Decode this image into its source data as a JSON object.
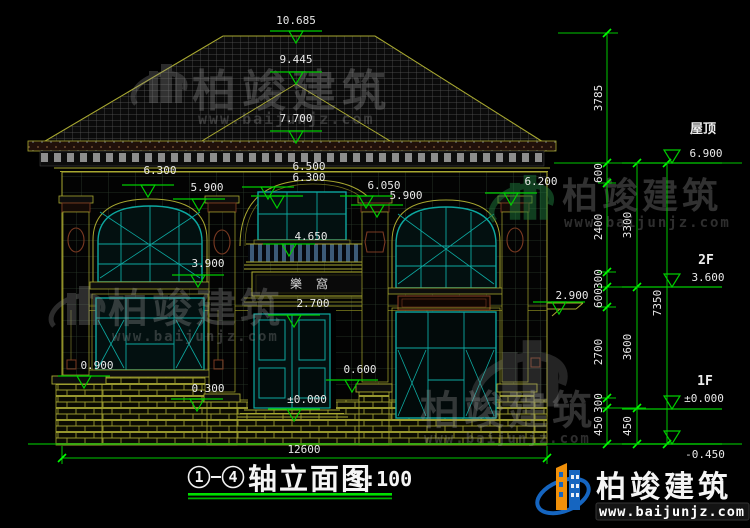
{
  "watermark": {
    "brand": "柏竣建筑",
    "url": "www.baijunjz.com"
  },
  "logo": {
    "brand": "柏竣建筑",
    "url": "www.baijunjz.com"
  },
  "title": {
    "axis_start": "1",
    "axis_end": "4",
    "name": "轴立面图",
    "scale": "1:100"
  },
  "signboard": {
    "text": "樂窩"
  },
  "elevation_markers": {
    "ridge": "10.685",
    "sub_ridge": "9.445",
    "eave_top": "7.700",
    "center_arch_top": "6.500",
    "center_arch_bottom": "6.300",
    "left_arch_top": "6.300",
    "left_window_head": "5.900",
    "center_capital_top": "6.050",
    "center_capital_bottom": "5.900",
    "right_capital": "6.200",
    "balcony_rail": "4.650",
    "left_window_sill": "3.900",
    "side_canopy": "2.900",
    "sign_level": "2.700",
    "left_pier": "0.900",
    "porch_wall": "0.300",
    "threshold": "±0.000",
    "right_pier": "0.600"
  },
  "levels": {
    "roof_label": "屋顶",
    "roof_value": "6.900",
    "f2_label": "2F",
    "f2_value": "3.600",
    "f1_label": "1F",
    "f1_value": "±0.000",
    "ground_value": "-0.450"
  },
  "dimensions": {
    "roof_height": "3785",
    "chain_a": [
      "600",
      "2400",
      "300",
      "600",
      "2700",
      "300",
      "450"
    ],
    "chain_b": [
      "3300",
      "3600",
      "450"
    ],
    "total_height": "7350",
    "total_width": "12600"
  }
}
